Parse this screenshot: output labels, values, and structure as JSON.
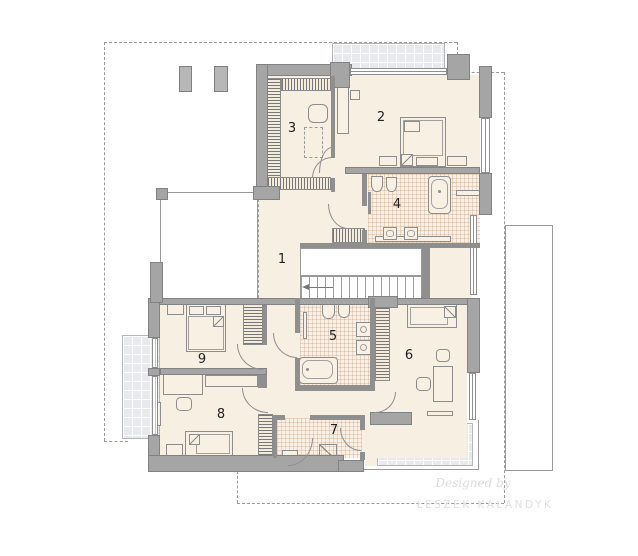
{
  "plan": {
    "kind": "upper-floor-plan"
  },
  "rooms": [
    {
      "label": "1",
      "name": "hall-landing"
    },
    {
      "label": "2",
      "name": "bedroom-master"
    },
    {
      "label": "3",
      "name": "wardrobe-room"
    },
    {
      "label": "4",
      "name": "bathroom-main"
    },
    {
      "label": "5",
      "name": "bathroom-second"
    },
    {
      "label": "6",
      "name": "bedroom-east"
    },
    {
      "label": "7",
      "name": "utility-room"
    },
    {
      "label": "8",
      "name": "bedroom-south"
    },
    {
      "label": "9",
      "name": "bedroom-west"
    }
  ],
  "watermark": {
    "line1": "Designed by",
    "line2": "LESZEK KALANDYK"
  },
  "colors": {
    "wall": "#a5a5a5",
    "floor": "#f6efe2",
    "bathroom_tile": "#f9efe4",
    "balcony": "#e7e9ec",
    "outline": "#8d8d8d",
    "dashed_boundary": "#9a9a9a",
    "label": "#222222",
    "watermark": "#dcdcdc"
  }
}
